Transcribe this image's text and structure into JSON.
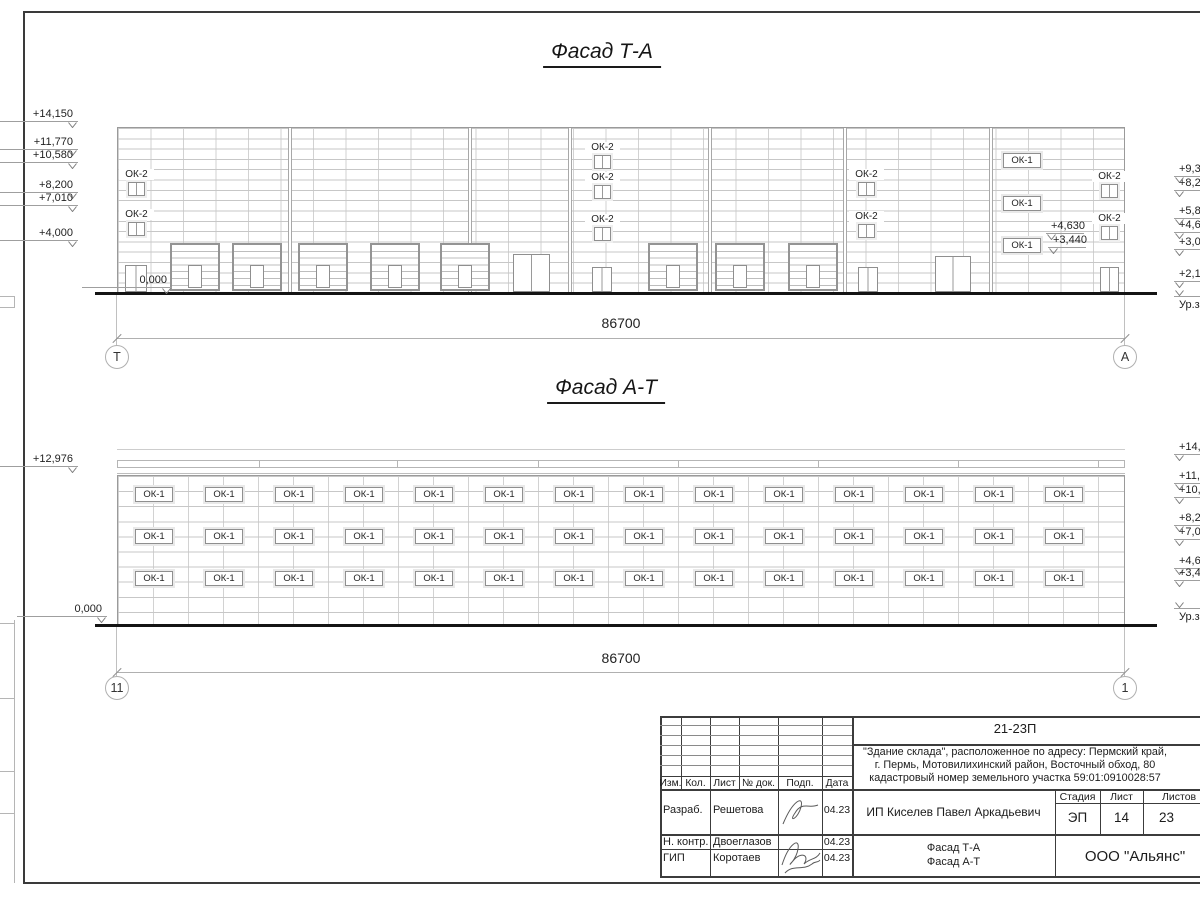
{
  "labels": {
    "ok1": "ОК-1",
    "ok2": "ОК-2"
  },
  "facade1": {
    "title": "Фасад Т-А",
    "dim": "86700",
    "axes": [
      {
        "t": "Т",
        "cx": 117
      },
      {
        "t": "А",
        "cx": 1125
      }
    ],
    "levels": [
      {
        "t": "+14,150",
        "x": 78,
        "y": 108,
        "side": "left"
      },
      {
        "t": "+11,770",
        "x": 78,
        "y": 136,
        "side": "left"
      },
      {
        "t": "+10,580",
        "x": 78,
        "y": 149,
        "side": "left"
      },
      {
        "t": "+8,200",
        "x": 78,
        "y": 179,
        "side": "left"
      },
      {
        "t": "+7,010",
        "x": 78,
        "y": 192,
        "side": "left"
      },
      {
        "t": "+4,000",
        "x": 78,
        "y": 227,
        "side": "left"
      },
      {
        "t": "0,000",
        "x": 172,
        "y": 274,
        "side": "left"
      },
      {
        "t": "+4,630",
        "x": 1046,
        "y": 220,
        "side": "mid"
      },
      {
        "t": "+3,440",
        "x": 1048,
        "y": 234,
        "side": "mid"
      },
      {
        "t": "+9,390",
        "x": 1174,
        "y": 163,
        "side": "right"
      },
      {
        "t": "+8,200",
        "x": 1174,
        "y": 177,
        "side": "right"
      },
      {
        "t": "+5,820",
        "x": 1174,
        "y": 205,
        "side": "right"
      },
      {
        "t": "+4,630",
        "x": 1174,
        "y": 219,
        "side": "right"
      },
      {
        "t": "+3,000",
        "x": 1174,
        "y": 236,
        "side": "right"
      },
      {
        "t": "+2,100",
        "x": 1174,
        "y": 268,
        "side": "right"
      },
      {
        "t": "Ур.земли",
        "x": 1174,
        "y": 296,
        "side": "right",
        "ground": true
      }
    ],
    "ok2_windows": [
      [
        128,
        182
      ],
      [
        128,
        222
      ],
      [
        594,
        155
      ],
      [
        594,
        185
      ],
      [
        594,
        227
      ],
      [
        858,
        182
      ],
      [
        858,
        224
      ],
      [
        1101,
        184
      ],
      [
        1101,
        226
      ]
    ],
    "ok1_windows": [
      [
        1003,
        153
      ],
      [
        1003,
        196
      ],
      [
        1003,
        238
      ]
    ],
    "garage_doors": [
      170,
      232,
      298,
      370,
      440,
      648,
      715,
      788
    ],
    "single_doors": [
      [
        125,
        265,
        22
      ],
      [
        592,
        267,
        20
      ],
      [
        858,
        267,
        20
      ],
      [
        1100,
        267,
        19
      ]
    ],
    "double_doors": [
      [
        513,
        254,
        37
      ],
      [
        935,
        256,
        36
      ]
    ],
    "bays": [
      290,
      470,
      570,
      710,
      845,
      991
    ]
  },
  "facade2": {
    "title": "Фасад А-Т",
    "dim": "86700",
    "axes": [
      {
        "t": "11",
        "cx": 117
      },
      {
        "t": "1",
        "cx": 1125
      }
    ],
    "levels": [
      {
        "t": "+12,976",
        "x": 78,
        "y": 453,
        "side": "left"
      },
      {
        "t": "0,000",
        "x": 107,
        "y": 603,
        "side": "left"
      },
      {
        "t": "+14,150",
        "x": 1174,
        "y": 441,
        "side": "right"
      },
      {
        "t": "+11,770",
        "x": 1174,
        "y": 470,
        "side": "right"
      },
      {
        "t": "+10,580",
        "x": 1174,
        "y": 484,
        "side": "right"
      },
      {
        "t": "+8,200",
        "x": 1174,
        "y": 512,
        "side": "right"
      },
      {
        "t": "+7,010",
        "x": 1174,
        "y": 526,
        "side": "right"
      },
      {
        "t": "+4,630",
        "x": 1174,
        "y": 555,
        "side": "right"
      },
      {
        "t": "+3,440",
        "x": 1174,
        "y": 567,
        "side": "right"
      },
      {
        "t": "Ур.земли",
        "x": 1174,
        "y": 608,
        "side": "right",
        "ground": true
      }
    ],
    "ok1_rows": [
      487,
      529,
      571
    ],
    "ok1_cols": [
      135,
      205,
      275,
      345,
      415,
      485,
      555,
      625,
      695,
      765,
      835,
      905,
      975,
      1045
    ],
    "parapet_dividers": [
      259,
      397,
      538,
      678,
      818,
      958,
      1098
    ]
  },
  "titleblock": {
    "code": "21-23П",
    "address1": "\"Здание склада\", расположенное по адресу: Пермский край,",
    "address2": "г. Пермь, Мотовилихинский район, Восточный обход, 80",
    "address3": "кадастровый номер земельного участка 59:01:0910028:57",
    "cols": {
      "izm": "Изм.",
      "kol": "Кол.",
      "list": "Лист",
      "ndok": "№ док.",
      "podp": "Подп.",
      "data": "Дата"
    },
    "rows": [
      {
        "role": "Разраб.",
        "name": "Решетова",
        "date": "04.23"
      },
      {
        "role": "Н. контр.",
        "name": "Двоеглазов",
        "date": "04.23"
      },
      {
        "role": "ГИП",
        "name": "Коротаев",
        "date": "04.23"
      }
    ],
    "client": "ИП Киселев Павел Аркадьевич",
    "stage_label": "Стадия",
    "sheet_label": "Лист",
    "sheets_label": "Листов",
    "stage": "ЭП",
    "sheet_no": "14",
    "sheets_total": "23",
    "doc_title1": "Фасад Т-А",
    "doc_title2": "Фасад А-Т",
    "company": "ООО \"Альянс\""
  }
}
